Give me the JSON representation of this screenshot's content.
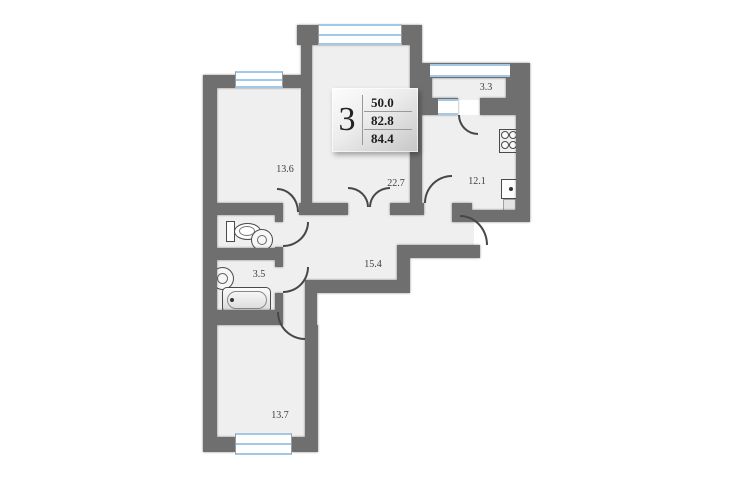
{
  "plan": {
    "type": "apartment-floor-plan",
    "badge": {
      "room_count": "3",
      "values": [
        "50.0",
        "82.8",
        "84.4"
      ]
    },
    "rooms": [
      {
        "id": "bedroom-left",
        "area": "13.6"
      },
      {
        "id": "living-room",
        "area": "22.7"
      },
      {
        "id": "balcony",
        "area": "3.3"
      },
      {
        "id": "kitchen",
        "area": "12.1"
      },
      {
        "id": "bathroom",
        "area": "3.5"
      },
      {
        "id": "hallway",
        "area": "15.4"
      },
      {
        "id": "bedroom-bottom",
        "area": "13.7"
      }
    ],
    "fixtures": [
      "toilet",
      "washbasin",
      "bathtub",
      "stove",
      "kitchen-sink"
    ],
    "colors": {
      "wall": "#6f6f6f",
      "floor": "#efefef",
      "window_frame": "#a3c8e6",
      "background": "#ffffff"
    }
  }
}
